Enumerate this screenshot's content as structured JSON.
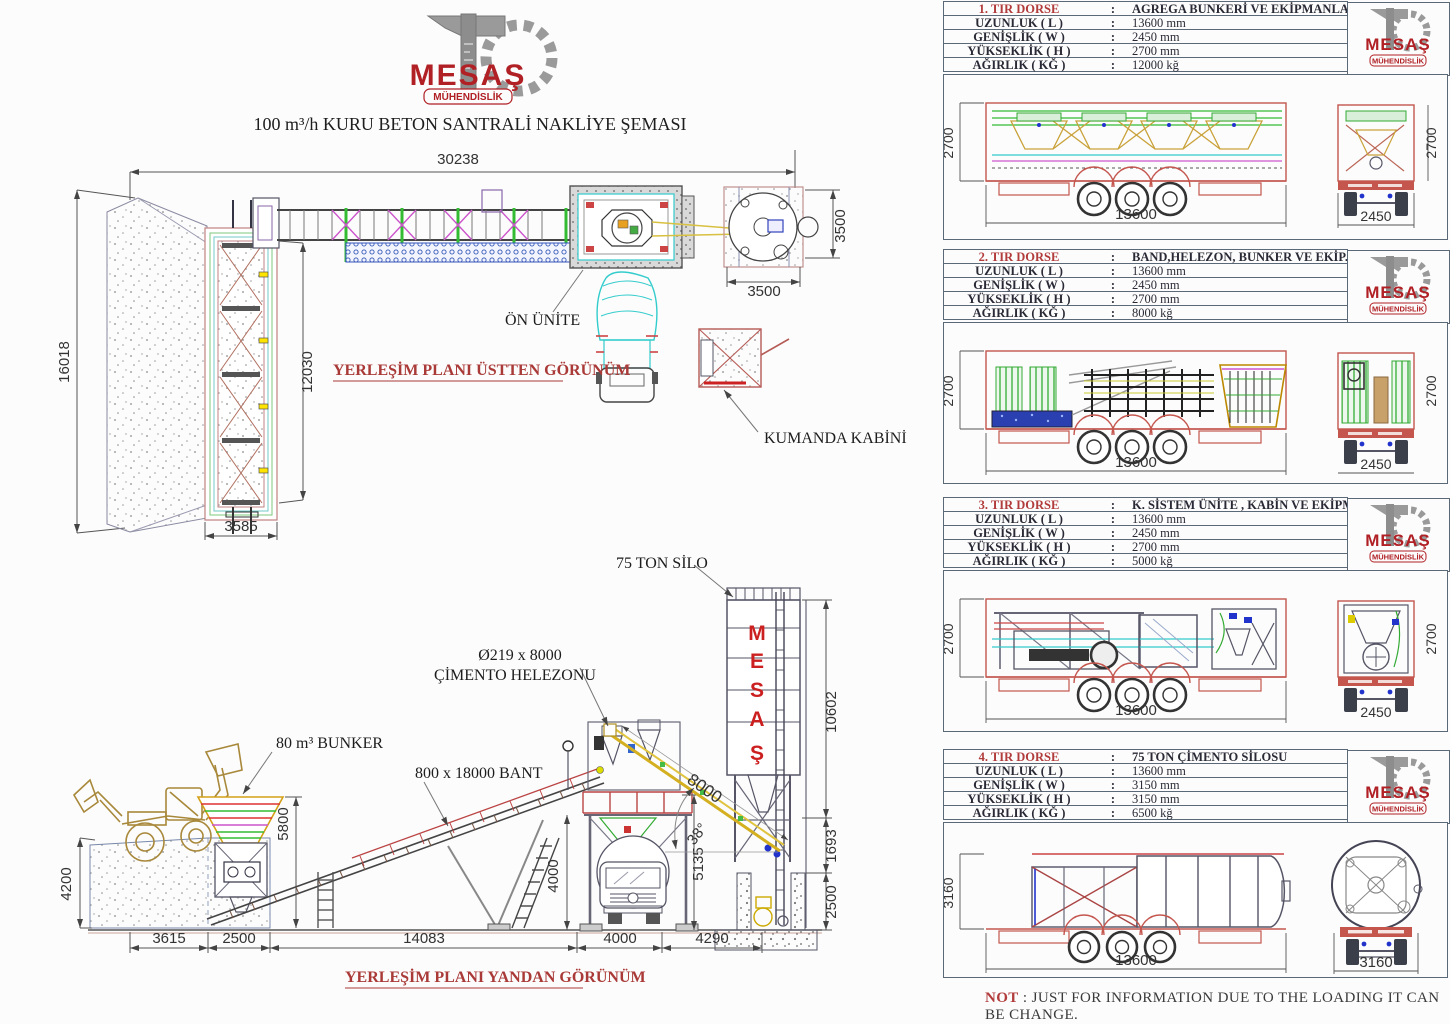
{
  "logo": {
    "name": "MESAŞ",
    "sub": "MÜHENDİSLİK"
  },
  "title": "100 m³/h KURU BETON SANTRALİ NAKLİYE ŞEMASI",
  "colon": ":",
  "top_view": {
    "caption": "YERLEŞİM PLANI ÜSTTEN GÖRÜNÜM",
    "labels": {
      "front_unit": "ÖN ÜNİTE",
      "control_cabin": "KUMANDA KABİNİ"
    },
    "dims": {
      "total_length": "30238",
      "total_depth": "16018",
      "bunker_length": "12030",
      "bunker_width": "3585",
      "silo_side": "3500",
      "silo_bottom": "3500"
    }
  },
  "side_view": {
    "caption": "YERLEŞİM PLANI YANDAN GÖRÜNÜM",
    "labels": {
      "bunker": "80 m³ BUNKER",
      "belt": "800 x 18000 BANT",
      "screw_line1": "Ø219 x 8000",
      "screw_line2": "ÇİMENTO HELEZONU",
      "silo": "75 TON SİLO",
      "angle": "38°",
      "screw_length": "8000",
      "silo_letters": [
        "M",
        "E",
        "S",
        "A",
        "Ş"
      ]
    },
    "dims": {
      "ramp_height": "4200",
      "bunker_height": "5800",
      "d_ramp": "3615",
      "d_feeder": "2500",
      "d_belt": "14083",
      "d_bay": "4000",
      "d_silo": "4290",
      "frame_height": "4000",
      "mixer_height": "5135",
      "silo_height": "10602",
      "discharge": "1693",
      "pit_depth": "2500"
    }
  },
  "row_labels": [
    "UZUNLUK ( L )",
    "GENİŞLİK ( W )",
    "YÜKSEKLİK ( H )",
    "AĞIRLIK ( KĞ )"
  ],
  "tables": [
    {
      "no": "1. TIR DORSE",
      "desc": "AGREGA BUNKERİ VE EKİPMANLARI",
      "values": [
        "13600 mm",
        "2450 mm",
        "2700 mm",
        "12000 kğ"
      ],
      "side_h": "2700",
      "side_l": "13600",
      "rear_w": "2450",
      "rear_h": "2700"
    },
    {
      "no": "2. TIR DORSE",
      "desc": "BAND,HELEZON, BUNKER VE EKİP.",
      "values": [
        "13600 mm",
        "2450 mm",
        "2700 mm",
        "8000 kğ"
      ],
      "side_h": "2700",
      "side_l": "13600",
      "rear_w": "2450",
      "rear_h": "2700"
    },
    {
      "no": "3. TIR DORSE",
      "desc": "K. SİSTEM ÜNİTE , KABİN VE EKİPMANLARI",
      "values": [
        "13600 mm",
        "2450 mm",
        "2700 mm",
        "5000 kğ"
      ],
      "side_h": "2700",
      "side_l": "13600",
      "rear_w": "2450",
      "rear_h": "2700"
    },
    {
      "no": "4. TIR DORSE",
      "desc": "75 TON ÇİMENTO SİLOSU",
      "values": [
        "13600 mm",
        "3150 mm",
        "3150 mm",
        "6500 kğ"
      ],
      "side_h": "3160",
      "side_l": "13600",
      "rear_w": "3160",
      "rear_h": ""
    }
  ],
  "note": {
    "prefix": "NOT",
    "text": " : JUST FOR INFORMATION DUE TO THE LOADING IT CAN BE CHANGE."
  },
  "colors": {
    "red_text": "#b23b3b",
    "trailer_red": "#c4564e",
    "logo_red": "#b02025",
    "green": "#33bb33",
    "magenta": "#cc55cc",
    "cyan": "#33cccc",
    "yellow": "#d4b020",
    "border": "#5a6878"
  }
}
